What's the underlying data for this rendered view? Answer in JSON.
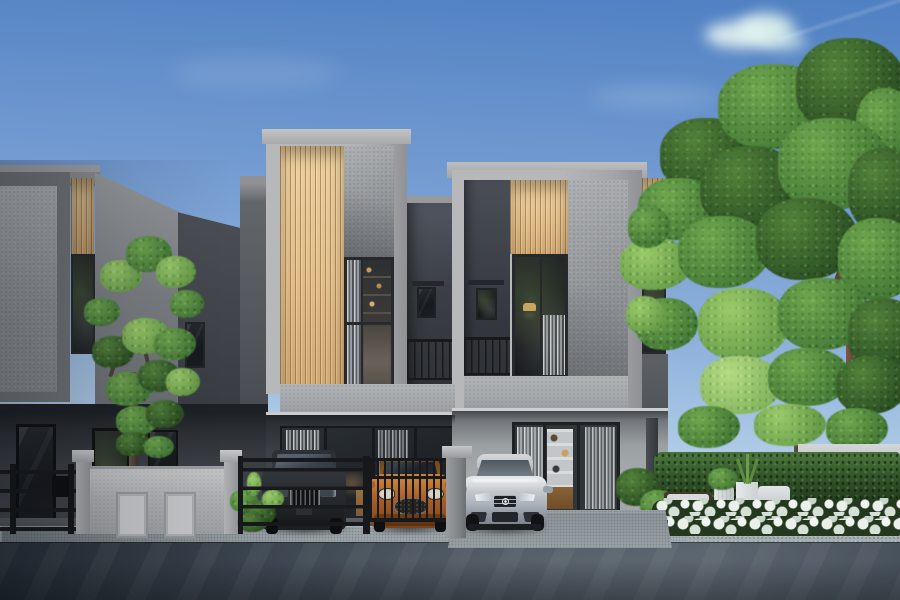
{
  "scene": {
    "type": "photorealistic exterior rendering",
    "subject": "modern two-storey townhouses at dusk-lit afternoon with clear blue sky",
    "sky": {
      "clouds": 2,
      "wisps": 2,
      "contrail": true
    },
    "buildings": [
      {
        "name": "left-townhouse",
        "materials": [
          "speckled grey render panel",
          "timber slat accent",
          "dark charcoal side wall"
        ],
        "windows": [
          "tall slat window",
          "small charcoal-wall window",
          "ground floor glazing"
        ]
      },
      {
        "name": "center-townhouse",
        "materials": [
          "light grey box frame",
          "vertical timber slats",
          "speckled grey render"
        ],
        "windows": [
          "double-height feature window with shelving and curtain"
        ],
        "balcony": true
      },
      {
        "name": "right-townhouse",
        "materials": [
          "light grey box frame",
          "vertical timber slats",
          "speckled grey render"
        ],
        "windows": [
          "tall living window with lamp",
          "small balcony window",
          "ground floor glass sliding doors with white bookshelf interior"
        ],
        "balcony": true
      }
    ],
    "vehicles": [
      {
        "name": "dark-suv",
        "color": "#26292d",
        "position": "left carport behind horizontal-rail gate"
      },
      {
        "name": "orange-hatchback",
        "color": "#a85f28",
        "position": "middle carport behind vertical-bar gate"
      },
      {
        "name": "silver-mercedes-sedan",
        "color": "#c3c8cd",
        "position": "right driveway, grille star visible"
      }
    ],
    "foreground": [
      {
        "name": "black-metal-railing",
        "color": "#17191c"
      },
      {
        "name": "light-grey-fence-wall",
        "color": "#b7b9bb",
        "details": "two pillars with caps, two recessed panels"
      },
      {
        "name": "grey-gate-pillar",
        "color": "#9a9da0"
      },
      {
        "name": "asphalt-street",
        "color": "#3e4852"
      },
      {
        "name": "concrete-sidewalk",
        "color": "#97a0a4"
      }
    ],
    "garden": [
      {
        "name": "left-tree",
        "foliage": "airy light green"
      },
      {
        "name": "right-tree-group",
        "foliage": "dense green canopy"
      },
      {
        "name": "clipped-hedge",
        "color": "#24381f"
      },
      {
        "name": "white-hydrangea-bed",
        "color": "#eaf0ea"
      },
      {
        "name": "white-planters-and-outdoor-seating",
        "colors": [
          "#dde0e2",
          "#332a21"
        ]
      }
    ]
  },
  "palette": {
    "sky_top": "#4f80c2",
    "sky_mid": "#8fb2dc",
    "sky_horizon": "#d6e6f3",
    "frame_light": "#b6b8ba",
    "frame_shade": "#8f9194",
    "slat_light": "#eccf9e",
    "slat_dark": "#cfa872",
    "charcoal_light": "#4b4f55",
    "charcoal_dark": "#33373d",
    "glass_dark": "#16191d",
    "metal_black": "#17191c",
    "leaf_dark": "#2e5226",
    "leaf_mid": "#49803a",
    "leaf_light": "#6fa44d",
    "leaf_pale": "#8abc62",
    "flower_white": "#eaf0ea",
    "road_dark": "#272f39",
    "road_light": "#555f69",
    "sidewalk": "#97a0a4",
    "hedge_dark": "#24381f",
    "suv_body": "#26292d",
    "car_orange": "#a85f28",
    "car_silver": "#c3c8cd",
    "interior_warm": "#c9a45e",
    "planter_white": "#dde0e2",
    "trunk": "#6b5240"
  }
}
